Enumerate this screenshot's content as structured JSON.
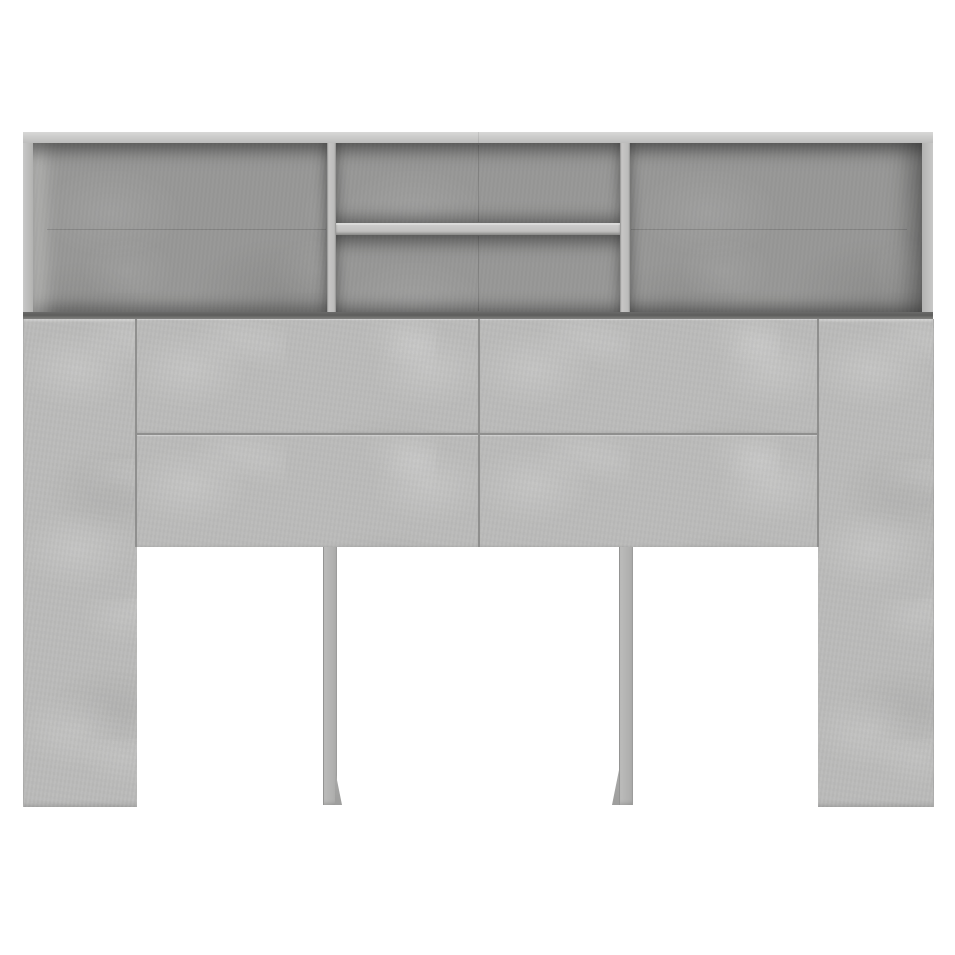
{
  "image": {
    "domain": "natural-image",
    "description": "Studio product photograph of a concrete-grey headboard cabinet on a plain white background: an open top shelf unit with two vertical dividers and a middle shelf creating four compartments, four flush drawer-front panels below, wide side columns and two thin centre support legs",
    "visible_text": "none"
  },
  "scene": {
    "object": "headboard-cabinet",
    "finish": "concrete grey",
    "top_shelf_compartments": 4,
    "front_panels": 4,
    "legs": 4
  },
  "palette": {
    "background": "#ffffff",
    "top_face": "#cecdcc",
    "frame": "#c2c2c1",
    "divider": "#c3c3c2",
    "shelf_edge": "#c6c6c5",
    "interior": "#989897",
    "panel": "#bcbcbb",
    "leg": "#b9b9b8",
    "support_leg": "#b2b2b1",
    "support_wedge": "#a3a3a2",
    "seam": "#8f8f8e",
    "shadow_band": "#5f5f5e"
  }
}
